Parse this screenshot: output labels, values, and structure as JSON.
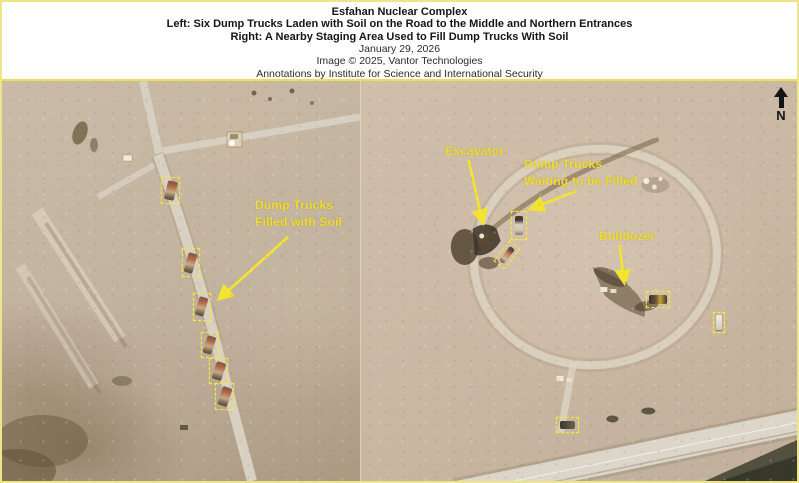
{
  "header": {
    "title": "Esfahan Nuclear Complex",
    "caption_left": "Left: Six Dump Trucks Laden with Soil on the Road to the Middle and Northern Entrances",
    "caption_right": "Right: A Nearby Staging Area Used to Fill Dump Trucks With Soil",
    "date": "January 29, 2026",
    "image_credit": "Image © 2025, Vantor Technologies",
    "annotation_credit": "Annotations by Institute for Science and International Security"
  },
  "compass": {
    "label": "N"
  },
  "colors": {
    "annotation_yellow": "#f1df2d",
    "box_yellow": "#f6e93a",
    "frame_yellow": "#ece58a",
    "terrain_tan": "#c3b4a0"
  },
  "left_panel": {
    "annotation": {
      "line1": "Dump Trucks",
      "line2": "Filled with Soil"
    },
    "boxes": [
      {
        "kind": "truck",
        "x": 159,
        "y": 96,
        "w": 19,
        "h": 27,
        "vrot": 14
      },
      {
        "kind": "truck",
        "x": 180,
        "y": 167,
        "w": 18,
        "h": 29,
        "vrot": 16
      },
      {
        "kind": "truck",
        "x": 191,
        "y": 212,
        "w": 18,
        "h": 28,
        "vrot": 16
      },
      {
        "kind": "truck",
        "x": 199,
        "y": 251,
        "w": 18,
        "h": 26,
        "vrot": 18
      },
      {
        "kind": "truck",
        "x": 207,
        "y": 277,
        "w": 19,
        "h": 26,
        "vrot": 18
      },
      {
        "kind": "truck",
        "x": 213,
        "y": 302,
        "w": 19,
        "h": 27,
        "vrot": 18
      }
    ]
  },
  "right_panel": {
    "labels": {
      "excavator": "Excavator",
      "dump_trucks_line1": "Dump Trucks",
      "dump_trucks_line2": "Waiting to be Filled",
      "bulldozer": "Bulldozer"
    },
    "boxes": [
      {
        "kind": "truck-v",
        "x": 150,
        "y": 130,
        "w": 16,
        "h": 29
      },
      {
        "kind": "truck-d",
        "x": 139,
        "y": 161,
        "w": 14,
        "h": 26,
        "rot": 38
      },
      {
        "kind": "dozer",
        "x": 285,
        "y": 210,
        "w": 24,
        "h": 17
      },
      {
        "kind": "vehicle-white",
        "x": 352,
        "y": 231,
        "w": 12,
        "h": 21
      },
      {
        "kind": "vehicle-dark",
        "x": 195,
        "y": 336,
        "w": 23,
        "h": 16
      }
    ]
  }
}
